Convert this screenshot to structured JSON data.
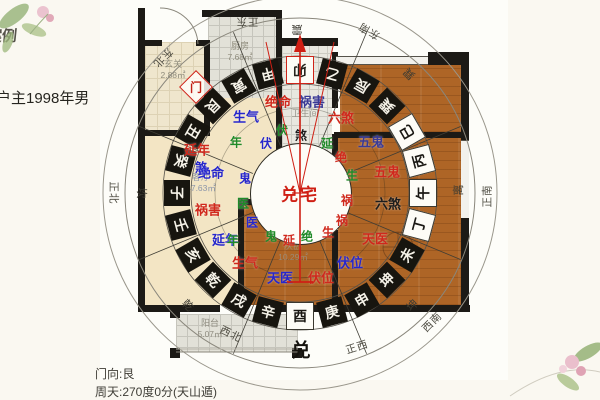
{
  "meta": {
    "case_label": "案例",
    "owner_label": "户主1998年男",
    "door_facing": "门向:艮",
    "compass_reading": "周天:270度0分(天山遁)",
    "house_label": "兑宅",
    "door_marker_char": "门"
  },
  "colors": {
    "red": "#d0281c",
    "blue": "#2626cc",
    "navy": "#3a3a96",
    "green": "#1f8a28",
    "black": "#1c1c1c",
    "accent_red": "#cf1f14",
    "wall": "#1c1a16",
    "wood": "#ae6526"
  },
  "rooms": [
    {
      "name": "玄关",
      "area": "2.88㎡",
      "x": 173,
      "y": 70,
      "tone": "#8f8c7c"
    },
    {
      "name": "厨房",
      "area": "7.68㎡",
      "x": 240,
      "y": 52,
      "tone": "#8f8c7c"
    },
    {
      "name": "卫生间",
      "area": "",
      "x": 305,
      "y": 114,
      "tone": "#96938a"
    },
    {
      "name": "客厅",
      "area": "47.63㎡",
      "x": 201,
      "y": 183,
      "tone": "#8b95a9"
    },
    {
      "name": "次卧",
      "area": "10.29㎡",
      "x": 293,
      "y": 252,
      "tone": "#9d8a74"
    },
    {
      "name": "阳台",
      "area": "5.07㎡",
      "x": 210,
      "y": 329,
      "tone": "#8f8c80"
    }
  ],
  "star_labels": [
    {
      "t": "生气",
      "c": "blue",
      "x": 246,
      "y": 116
    },
    {
      "t": "绝命",
      "c": "red",
      "x": 278,
      "y": 101
    },
    {
      "t": "祸害",
      "c": "navy",
      "x": 312,
      "y": 101
    },
    {
      "t": "六煞",
      "c": "red",
      "x": 341,
      "y": 117
    },
    {
      "t": "五鬼",
      "c": "navy",
      "x": 371,
      "y": 141
    },
    {
      "t": "五鬼",
      "c": "red",
      "x": 387,
      "y": 171
    },
    {
      "t": "六煞",
      "c": "black",
      "x": 388,
      "y": 203
    },
    {
      "t": "天医",
      "c": "red",
      "x": 375,
      "y": 238
    },
    {
      "t": "伏位",
      "c": "blue",
      "x": 350,
      "y": 262
    },
    {
      "t": "伏位",
      "c": "red",
      "x": 321,
      "y": 277
    },
    {
      "t": "天医",
      "c": "blue",
      "x": 280,
      "y": 277
    },
    {
      "t": "延年",
      "c": "red",
      "x": 197,
      "y": 149
    },
    {
      "t": "绝命",
      "c": "blue",
      "x": 211,
      "y": 172
    },
    {
      "t": "祸害",
      "c": "red",
      "x": 208,
      "y": 209
    },
    {
      "t": "延年",
      "c": "blue",
      "x": 225,
      "y": 239
    },
    {
      "t": "生气",
      "c": "red",
      "x": 245,
      "y": 262
    },
    {
      "t": "伏",
      "c": "green",
      "x": 282,
      "y": 130,
      "s": 1
    },
    {
      "t": "伏",
      "c": "blue",
      "x": 266,
      "y": 143,
      "s": 1
    },
    {
      "t": "煞",
      "c": "black",
      "x": 301,
      "y": 135,
      "s": 1
    },
    {
      "t": "延",
      "c": "green",
      "x": 327,
      "y": 143,
      "s": 1
    },
    {
      "t": "绝",
      "c": "red",
      "x": 341,
      "y": 157,
      "s": 1
    },
    {
      "t": "生",
      "c": "green",
      "x": 352,
      "y": 175,
      "s": 1
    },
    {
      "t": "祸",
      "c": "red",
      "x": 347,
      "y": 200,
      "s": 1
    },
    {
      "t": "祸",
      "c": "red",
      "x": 342,
      "y": 220,
      "s": 1
    },
    {
      "t": "生",
      "c": "red",
      "x": 328,
      "y": 232,
      "s": 1
    },
    {
      "t": "绝",
      "c": "green",
      "x": 307,
      "y": 236,
      "s": 1
    },
    {
      "t": "延",
      "c": "red",
      "x": 289,
      "y": 240,
      "s": 1
    },
    {
      "t": "鬼",
      "c": "green",
      "x": 271,
      "y": 236,
      "s": 1
    },
    {
      "t": "医",
      "c": "blue",
      "x": 252,
      "y": 222,
      "s": 1
    },
    {
      "t": "医",
      "c": "green",
      "x": 243,
      "y": 203,
      "s": 1
    },
    {
      "t": "鬼",
      "c": "blue",
      "x": 245,
      "y": 178,
      "s": 1
    },
    {
      "t": "煞",
      "c": "blue",
      "x": 201,
      "y": 167,
      "s": 1
    },
    {
      "t": "年",
      "c": "green",
      "x": 236,
      "y": 142,
      "s": 1
    },
    {
      "t": "年",
      "c": "green",
      "x": 233,
      "y": 240,
      "s": 1
    }
  ],
  "mountain_ring": {
    "radius": 123,
    "chars": [
      {
        "ch": "子",
        "deg": 180
      },
      {
        "ch": "癸",
        "deg": 165
      },
      {
        "ch": "丑",
        "deg": 150
      },
      {
        "ch": "艮",
        "deg": 135
      },
      {
        "ch": "寅",
        "deg": 120
      },
      {
        "ch": "甲",
        "deg": 105
      },
      {
        "ch": "卯",
        "deg": 90,
        "hl": 1
      },
      {
        "ch": "乙",
        "deg": 75
      },
      {
        "ch": "辰",
        "deg": 60
      },
      {
        "ch": "巽",
        "deg": 45
      },
      {
        "ch": "巳",
        "deg": 30,
        "w": 1
      },
      {
        "ch": "丙",
        "deg": 15,
        "w": 1
      },
      {
        "ch": "午",
        "deg": 0,
        "w": 1
      },
      {
        "ch": "丁",
        "deg": 345,
        "w": 1
      },
      {
        "ch": "未",
        "deg": 330
      },
      {
        "ch": "坤",
        "deg": 315
      },
      {
        "ch": "申",
        "deg": 300
      },
      {
        "ch": "庚",
        "deg": 285
      },
      {
        "ch": "酉",
        "deg": 270,
        "w": 1
      },
      {
        "ch": "辛",
        "deg": 255
      },
      {
        "ch": "戌",
        "deg": 240
      },
      {
        "ch": "乾",
        "deg": 225
      },
      {
        "ch": "亥",
        "deg": 210
      },
      {
        "ch": "壬",
        "deg": 195
      }
    ]
  },
  "trigrams": [
    {
      "ch": "震",
      "x": 297,
      "y": 30,
      "rot": 180
    },
    {
      "ch": "巽",
      "x": 409,
      "y": 74,
      "rot": -135
    },
    {
      "ch": "离",
      "x": 458,
      "y": 190,
      "rot": -90
    },
    {
      "ch": "坤",
      "x": 412,
      "y": 305,
      "rot": -45
    },
    {
      "ch": "兑",
      "x": 301,
      "y": 349,
      "rot": 0,
      "big": 1
    },
    {
      "ch": "乾",
      "x": 188,
      "y": 305,
      "rot": 45
    },
    {
      "ch": "坎",
      "x": 142,
      "y": 193,
      "rot": 90
    }
  ],
  "directions": [
    {
      "t": "正东",
      "x": 247,
      "y": 22,
      "rot": 180
    },
    {
      "t": "东南",
      "x": 369,
      "y": 31,
      "rot": -150
    },
    {
      "t": "正南",
      "x": 487,
      "y": 196,
      "rot": -90
    },
    {
      "t": "西南",
      "x": 432,
      "y": 322,
      "rot": -45
    },
    {
      "t": "正西",
      "x": 357,
      "y": 347,
      "rot": -18
    },
    {
      "t": "西北",
      "x": 231,
      "y": 334,
      "rot": 26
    },
    {
      "t": "正北",
      "x": 114,
      "y": 193,
      "rot": 90
    },
    {
      "t": "东北",
      "x": 163,
      "y": 58,
      "rot": 135
    }
  ]
}
